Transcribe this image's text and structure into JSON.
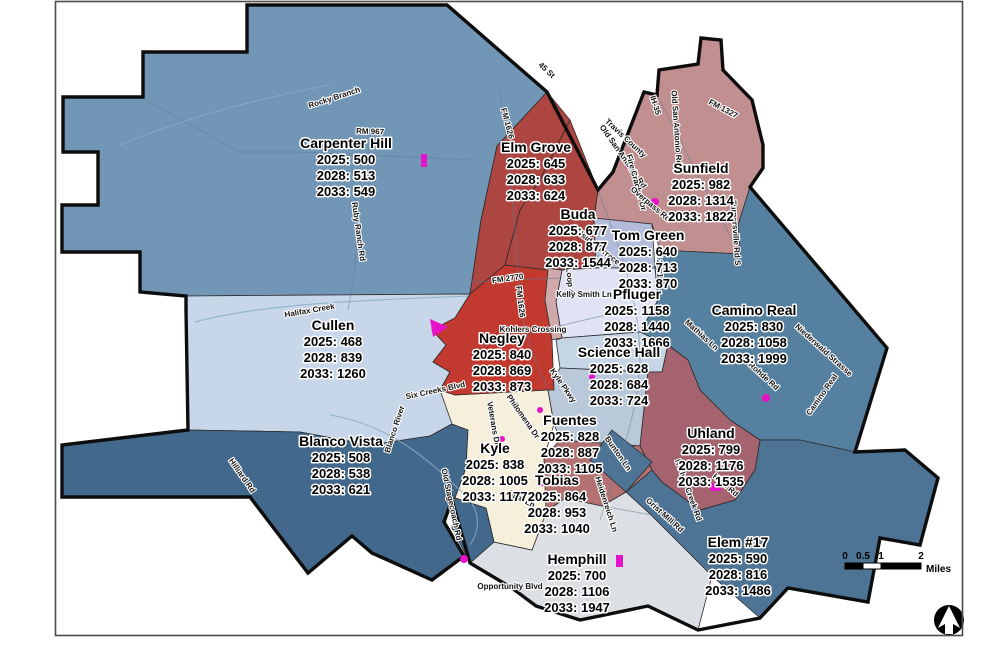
{
  "map": {
    "zones": [
      {
        "name": "Carpenter Hill",
        "lines": [
          "2025: 500",
          "2028: 513",
          "2033: 549"
        ],
        "color": "#7296b5"
      },
      {
        "name": "Elm Grove",
        "lines": [
          "2025: 645",
          "2028: 633",
          "2033: 624"
        ],
        "color": "#ad4540"
      },
      {
        "name": "Buda",
        "lines": [
          "2025: 677",
          "2028: 877",
          "2033: 1544"
        ],
        "color": "#ad4540"
      },
      {
        "name": "Sunfield",
        "lines": [
          "2025: 982",
          "2028: 1314",
          "2033: 1822"
        ],
        "color": "#c28f90"
      },
      {
        "name": "Tom Green",
        "lines": [
          "2025: 640",
          "2028: 713",
          "2033: 870"
        ],
        "color": "#b4bcdb"
      },
      {
        "name": "Cullen",
        "lines": [
          "2025: 468",
          "2028: 839",
          "2033: 1260"
        ],
        "color": "#c7d6e8"
      },
      {
        "name": "Negley",
        "lines": [
          "2025: 840",
          "2028: 869",
          "2033: 873"
        ],
        "color": "#c2392f"
      },
      {
        "name": "Pfluger",
        "lines": [
          "2025: 1158",
          "2028: 1440",
          "2033: 1666"
        ],
        "color": "#dfe3f4"
      },
      {
        "name": "Camino Real",
        "lines": [
          "2025: 830",
          "2028: 1058",
          "2033: 1999"
        ],
        "color": "#55809f"
      },
      {
        "name": "Science Hall",
        "lines": [
          "2025: 628",
          "2028: 684",
          "2033: 724"
        ],
        "color": "#c6d5e5"
      },
      {
        "name": "Fuentes",
        "lines": [
          "2025: 828",
          "2028: 887",
          "2033: 1105"
        ],
        "color": "#b9c9da"
      },
      {
        "name": "Uhland",
        "lines": [
          "2025: 799",
          "2028: 1176",
          "2033: 1535"
        ],
        "color": "#a5636f"
      },
      {
        "name": "Kyle",
        "lines": [
          "2025: 838",
          "2028: 1005",
          "2033: 1177"
        ],
        "color": "#f6efdb"
      },
      {
        "name": "Tobias",
        "lines": [
          "2025: 864",
          "2028: 953",
          "2033: 1040"
        ],
        "color": "#b37172"
      },
      {
        "name": "Blanco Vista",
        "lines": [
          "2025: 508",
          "2028: 538",
          "2033: 621"
        ],
        "color": "#42688c"
      },
      {
        "name": "Hemphill",
        "lines": [
          "2025: 700",
          "2028: 1106",
          "2033: 1947"
        ],
        "color": "#dce0e5"
      },
      {
        "name": "Elem #17",
        "lines": [
          "2025: 590",
          "2028: 816",
          "2033: 1486"
        ],
        "color": "#4d7495"
      }
    ],
    "roads": [
      {
        "label": "Rocky Branch"
      },
      {
        "label": "RM 967"
      },
      {
        "label": "Ruby Ranch Rd"
      },
      {
        "label": "FM 1626"
      },
      {
        "label": "45 St"
      },
      {
        "label": "Travis County"
      },
      {
        "label": "IH-35"
      },
      {
        "label": "Old San Antonio Rd"
      },
      {
        "label": "FM 1327"
      },
      {
        "label": "Old San Antonio Rd"
      },
      {
        "label": "Fire Cracker Dr"
      },
      {
        "label": "Overpass Rd"
      },
      {
        "label": "Turnersville Rd S"
      },
      {
        "label": "FM 2001"
      },
      {
        "label": "Hillside Terrace"
      },
      {
        "label": "S Loop 4"
      },
      {
        "label": "FM 2770"
      },
      {
        "label": "FM 1626"
      },
      {
        "label": "Kelly Smith Ln"
      },
      {
        "label": "Kohlers Crossing"
      },
      {
        "label": "Halifax Creek"
      },
      {
        "label": "Six Creeks Blvd"
      },
      {
        "label": "Blanco River"
      },
      {
        "label": "Veterans Dr"
      },
      {
        "label": "Philomena Dr"
      },
      {
        "label": "Kyle Pkwy"
      },
      {
        "label": "Hilliard Rd"
      },
      {
        "label": "Old Stagecoach Rd"
      },
      {
        "label": "Opal Ln"
      },
      {
        "label": "Opportunity Blvd"
      },
      {
        "label": "Bunton Ln"
      },
      {
        "label": "Heidenreich Ln"
      },
      {
        "label": "Grist Mill Rd"
      },
      {
        "label": "N Plum Creek Rd"
      },
      {
        "label": "High Rd"
      },
      {
        "label": "Mathias Ln"
      },
      {
        "label": "Rohde Rd"
      },
      {
        "label": "Niederwald Strasse"
      },
      {
        "label": "Camino Real"
      }
    ],
    "scalebar": {
      "ticks": [
        "0",
        "0.5",
        "1",
        "2"
      ],
      "unit": "Miles"
    },
    "colors": {
      "school_marker": "#e612c9",
      "district_boundary": "#0d0d0d"
    }
  }
}
